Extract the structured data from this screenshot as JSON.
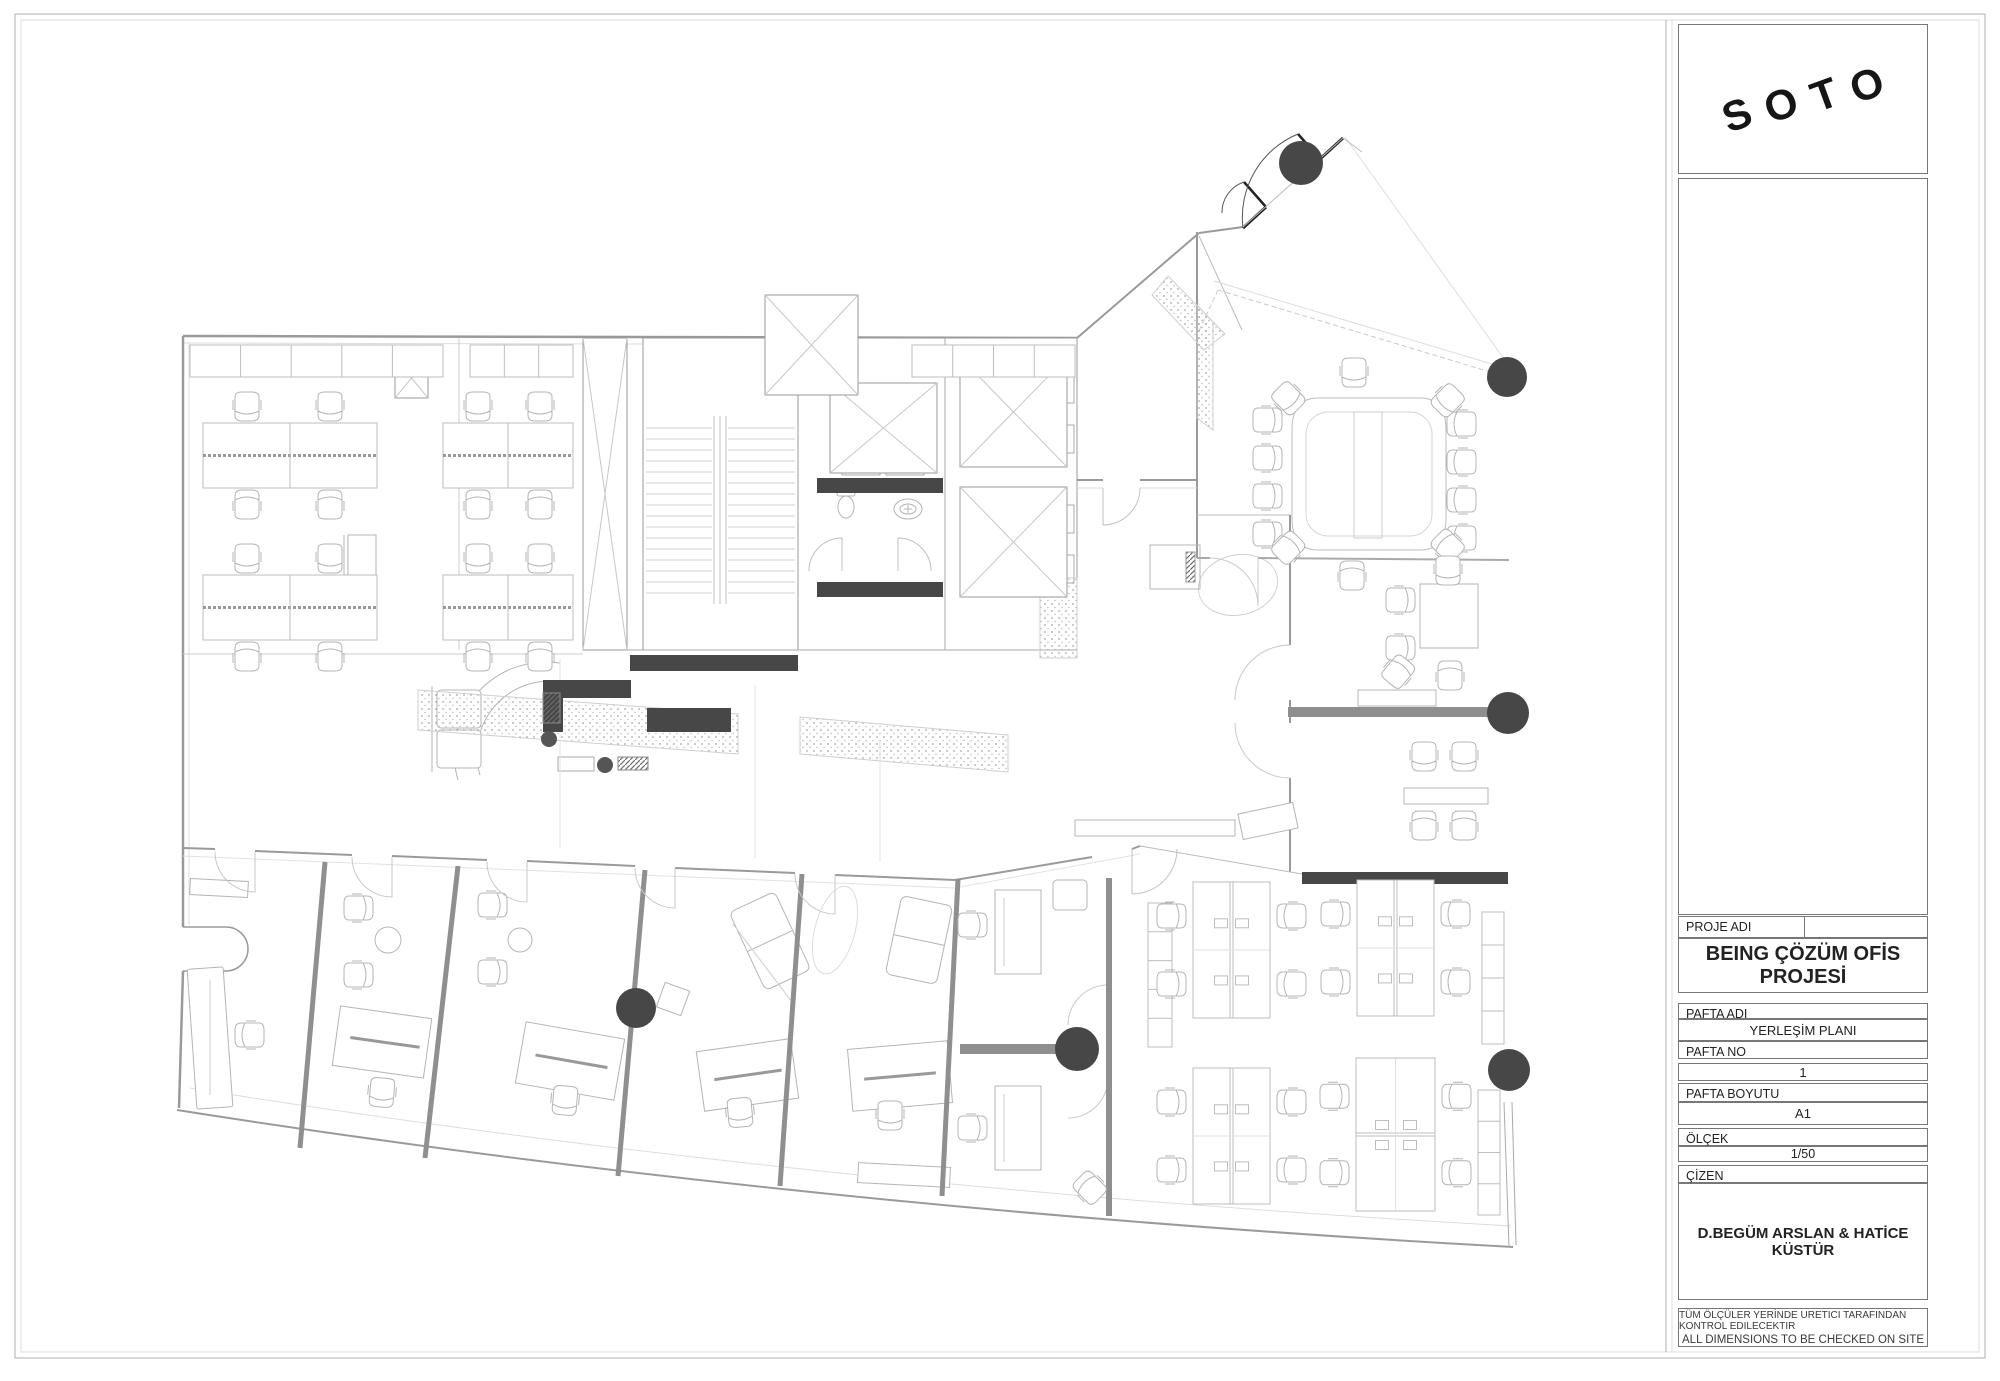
{
  "logo": {
    "letters": [
      "S",
      "O",
      "T",
      "O"
    ]
  },
  "title_block": {
    "proje_adi_label": "PROJE ADI",
    "project_name": "BEING ÇÖZÜM OFİS PROJESİ",
    "pafta_adi_label": "PAFTA ADI",
    "pafta_adi_value": "YERLEŞİM PLANI",
    "pafta_no_label": "PAFTA NO",
    "pafta_no_value": "1",
    "pafta_boyutu_label": "PAFTA BOYUTU",
    "pafta_boyutu_value": "A1",
    "olcek_label": "ÖLÇEK",
    "olcek_value": "1/50",
    "cizen_label": "ÇİZEN",
    "cizen_value": "D.BEGÜM ARSLAN & HATİCE KÜSTÜR",
    "note_line1": "TÜM ÖLÇÜLER YERİNDE URETICI TARAFINDAN KONTROL EDILECEKTIR",
    "note_line2": "ALL DIMENSIONS TO BE CHECKED ON SITE"
  },
  "colors": {
    "wall_dark": "#474747",
    "wall_gray": "#8f8f8f",
    "line_med": "#9a9a9a",
    "line_light": "#bdbdbd",
    "furniture": "#b4b4b4",
    "glass": "#c9c9c9"
  },
  "plan": {
    "columns": [
      [
        1301,
        163,
        22
      ],
      [
        1507,
        377,
        20
      ],
      [
        1508,
        713,
        21
      ],
      [
        1509,
        1070,
        21
      ],
      [
        1077,
        1049,
        22
      ],
      [
        636,
        1008,
        20
      ]
    ],
    "dots": [
      [
        549,
        739,
        8
      ],
      [
        605,
        765,
        8
      ]
    ],
    "hatch_rects": [
      [
        543,
        693,
        17,
        30
      ],
      [
        618,
        757,
        30,
        13
      ]
    ],
    "dark_rects": [
      [
        630,
        655,
        168,
        16
      ],
      [
        543,
        680,
        88,
        18
      ],
      [
        543,
        698,
        20,
        34
      ],
      [
        647,
        708,
        84,
        24
      ],
      [
        817,
        478,
        126,
        15
      ],
      [
        817,
        582,
        126,
        15
      ],
      [
        1302,
        872,
        206,
        12
      ]
    ],
    "gray_walls": [
      [
        1288,
        707,
        221,
        10
      ],
      [
        960,
        1044,
        120,
        10
      ],
      [
        1106,
        878,
        6,
        338
      ]
    ],
    "partitions": [
      [
        325,
        862,
        300,
        1148
      ],
      [
        458,
        866,
        425,
        1158
      ],
      [
        645,
        870,
        618,
        1176
      ],
      [
        802,
        874,
        780,
        1186
      ],
      [
        958,
        879,
        942,
        1196
      ]
    ],
    "benches": [
      {
        "x": 203,
        "y": 423,
        "w": 174,
        "h": 65,
        "cx": [
          247,
          330
        ]
      },
      {
        "x": 443,
        "y": 423,
        "w": 130,
        "h": 65,
        "cx": [
          478,
          540
        ]
      },
      {
        "x": 203,
        "y": 575,
        "w": 174,
        "h": 65,
        "cx": [
          247,
          330
        ]
      },
      {
        "x": 443,
        "y": 575,
        "w": 130,
        "h": 65,
        "cx": [
          478,
          540
        ]
      }
    ],
    "clusters": [
      {
        "x": 1193,
        "y": 882,
        "w": 77,
        "h": 136,
        "o": "v"
      },
      {
        "x": 1357,
        "y": 880,
        "w": 77,
        "h": 136,
        "o": "v"
      },
      {
        "x": 1193,
        "y": 1068,
        "w": 77,
        "h": 136,
        "o": "v"
      },
      {
        "x": 1356,
        "y": 1058,
        "w": 79,
        "h": 153,
        "o": "h"
      }
    ],
    "chairs": [
      [
        1267,
        420,
        90
      ],
      [
        1267,
        458,
        90
      ],
      [
        1267,
        496,
        90
      ],
      [
        1267,
        534,
        90
      ],
      [
        1462,
        424,
        270
      ],
      [
        1462,
        462,
        270
      ],
      [
        1462,
        500,
        270
      ],
      [
        1462,
        538,
        270
      ],
      [
        1354,
        372,
        180
      ],
      [
        1288,
        398,
        135
      ],
      [
        1448,
        400,
        225
      ],
      [
        1288,
        548,
        45
      ],
      [
        1448,
        546,
        315
      ],
      [
        1352,
        576,
        0
      ],
      [
        1400,
        600,
        90
      ],
      [
        1400,
        648,
        90
      ],
      [
        1448,
        570,
        180
      ],
      [
        1398,
        672,
        40
      ],
      [
        1450,
        676,
        0
      ],
      [
        1424,
        756,
        180
      ],
      [
        1464,
        756,
        180
      ],
      [
        1424,
        826,
        0
      ],
      [
        1464,
        826,
        0
      ],
      [
        250,
        1035,
        270
      ],
      [
        358,
        908,
        90
      ],
      [
        358,
        975,
        90
      ],
      [
        382,
        1092,
        185
      ],
      [
        492,
        905,
        90
      ],
      [
        492,
        972,
        90
      ],
      [
        565,
        1100,
        185
      ],
      [
        740,
        1112,
        175
      ],
      [
        890,
        1115,
        180
      ],
      [
        972,
        925,
        90
      ],
      [
        972,
        1128,
        90
      ],
      [
        1090,
        1188,
        315
      ]
    ],
    "cabinets": [
      [
        190,
        345,
        253,
        32,
        4
      ],
      [
        470,
        345,
        103,
        32,
        2
      ],
      [
        912,
        345,
        163,
        32,
        3
      ],
      [
        1482,
        912,
        22,
        132,
        3
      ],
      [
        1478,
        1090,
        22,
        125,
        3
      ],
      [
        1148,
        903,
        24,
        144,
        4
      ]
    ],
    "speckles": [
      "418,690 738,714 738,754 418,730",
      "800,717 1008,735 1008,772 800,754",
      "1040,578 1077,578 1077,658 1040,658",
      "1168,276 1225,334 1204,350 1152,295",
      "1197,305 1213,322 1213,430 1197,418"
    ],
    "xboxes": [
      [
        830,
        383,
        107,
        90
      ],
      [
        960,
        357,
        107,
        110
      ],
      [
        960,
        487,
        107,
        110
      ],
      [
        765,
        295,
        93,
        100
      ],
      [
        395,
        358,
        33,
        40
      ],
      [
        583,
        338,
        44,
        312
      ]
    ],
    "front_doors": [
      [
        255,
        852
      ],
      [
        392,
        857
      ],
      [
        527,
        862
      ],
      [
        675,
        868
      ],
      [
        835,
        874
      ]
    ],
    "stairs": {
      "x": 643,
      "y": 338,
      "w": 155,
      "h": 312,
      "ry1": 428,
      "ry2": 598,
      "step": 11,
      "rails": [
        714,
        720,
        726
      ]
    }
  }
}
